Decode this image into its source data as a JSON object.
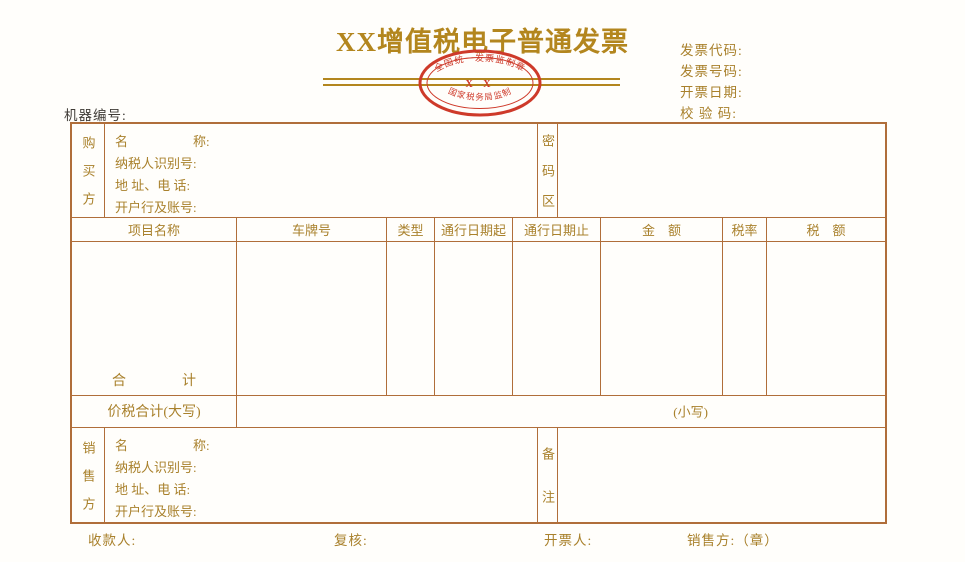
{
  "title": "XX增值税电子普通发票",
  "seal": {
    "arc_top": "全国统一发票监制章",
    "center": "X X",
    "arc_bottom": "国家税务局监制"
  },
  "machine_number_label": "机器编号:",
  "meta": {
    "invoice_code_label": "发票代码:",
    "invoice_number_label": "发票号码:",
    "invoice_date_label": "开票日期:",
    "check_code_label": "校 验 码:"
  },
  "buyer": {
    "party": "购买方",
    "rows": [
      "名　　　　　称:",
      "纳税人识别号:",
      "地 址、电 话:",
      "开户行及账号:"
    ],
    "password_area_label": "密码区"
  },
  "items_table": {
    "headers": [
      "项目名称",
      "车牌号",
      "类型",
      "通行日期起",
      "通行日期止",
      "金　额",
      "税率",
      "税　额"
    ],
    "total_row_label": "合　　　　计",
    "total_cn_label": "价税合计(大写)",
    "total_num_label": "(小写)"
  },
  "seller": {
    "party": "销售方",
    "rows": [
      "名　　　　　称:",
      "纳税人识别号:",
      "地 址、电 话:",
      "开户行及账号:"
    ],
    "remarks_label": "备注"
  },
  "footer": {
    "payee_label": "收款人:",
    "reviewer_label": "复核:",
    "drawer_label": "开票人:",
    "seller_seal_label": "销售方:（章）"
  },
  "colors": {
    "gold_text": "#a9812c",
    "title_gold": "#b3861e",
    "table_border": "#b06e3a",
    "seal_red": "#ce3a2a",
    "ink": "#3f3b36"
  }
}
